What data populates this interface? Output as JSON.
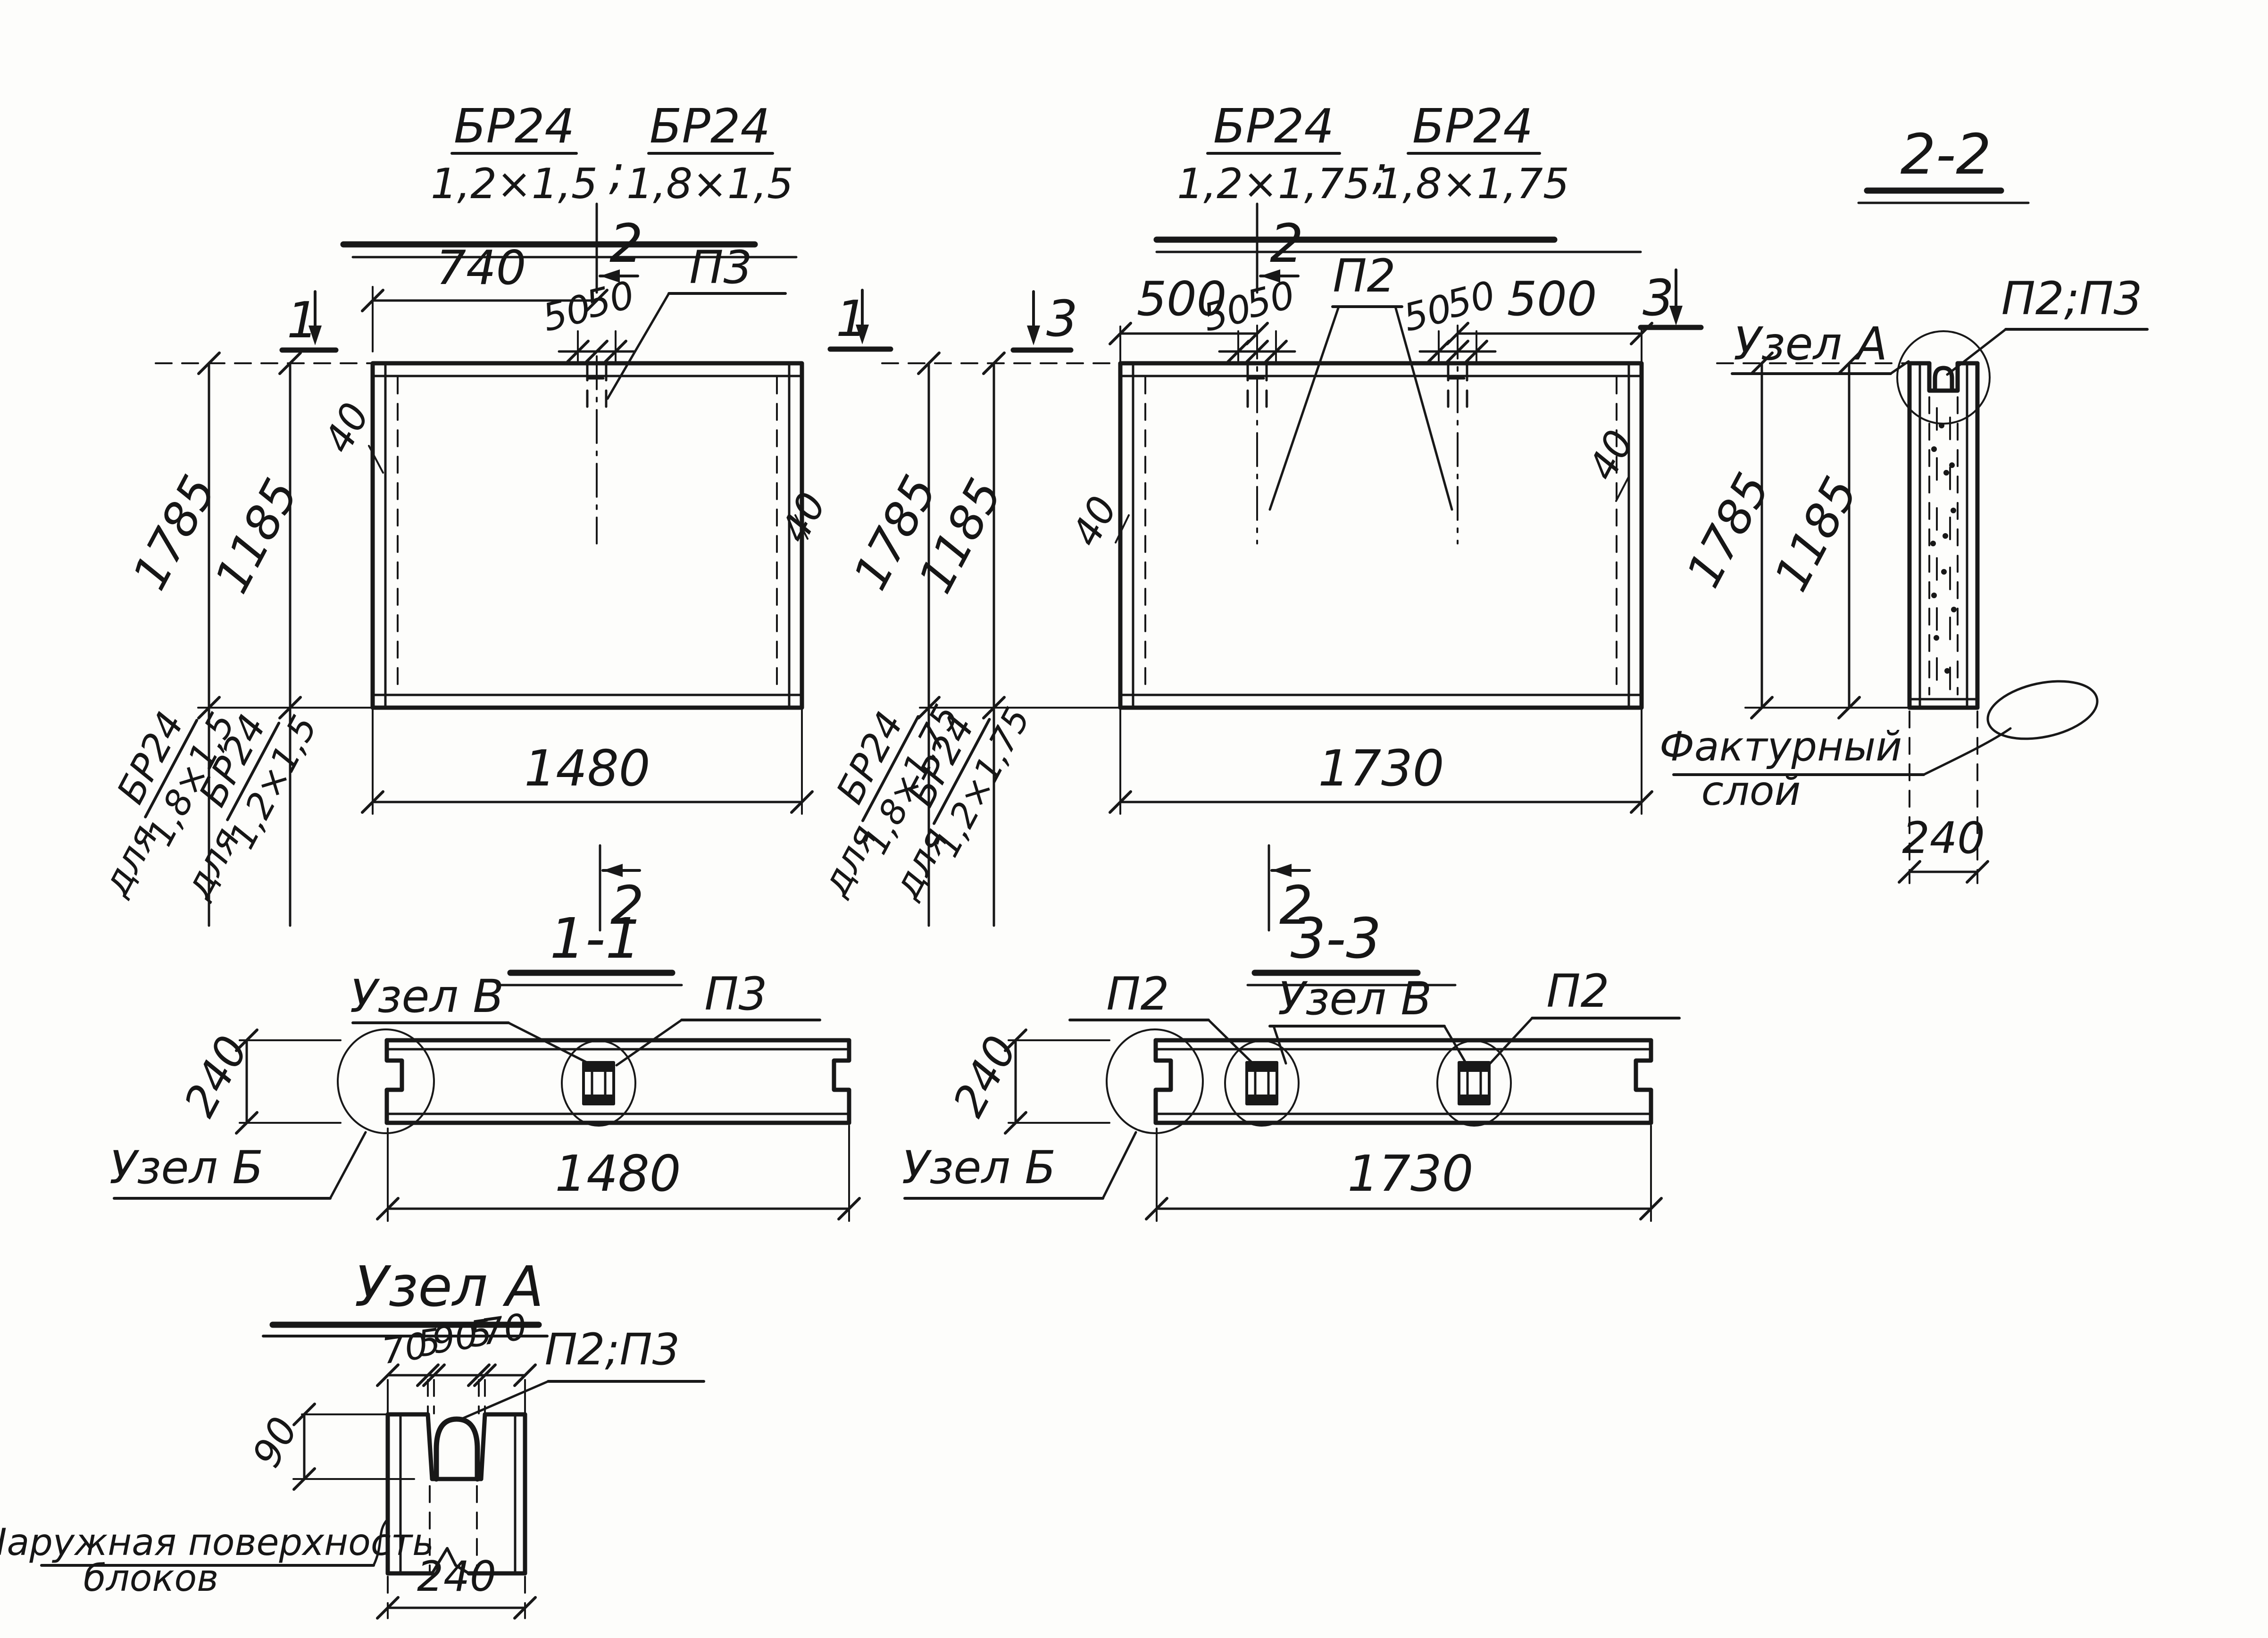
{
  "v1": {
    "t1n": "БР24",
    "t1d": "1,2×1,5",
    "sep": ";",
    "t2n": "БР24",
    "t2d": "1,8×1,5",
    "dim740": "740",
    "dim50a": "50",
    "dim50b": "50",
    "p3": "П3",
    "sec2top": "2",
    "sec2bot": "2",
    "sec1l": "1",
    "sec1r": "1",
    "dim1785": "1785",
    "dim1185": "1185",
    "dim1480": "1480",
    "dim40l": "40",
    "dim40r": "40",
    "fA_pre": "для",
    "fA_n": "БР24",
    "fA_d": "1,8×1,5",
    "fB_pre": "для",
    "fB_n": "БР24",
    "fB_d": "1,2×1,5"
  },
  "v2": {
    "t1n": "БР24",
    "t1d": "1,2×1,75",
    "sep": ";",
    "t2n": "БР24",
    "t2d": "1,8×1,75",
    "dim500l": "500",
    "dim500r": "500",
    "dim50a": "50",
    "dim50b": "50",
    "dim50c": "50",
    "dim50d": "50",
    "p2": "П2",
    "sec2top": "2",
    "sec2bot": "2",
    "sec3l": "3",
    "sec3r": "3",
    "dim1785": "1785",
    "dim1185": "1185",
    "dim1730": "1730",
    "dim40l": "40",
    "dim40r": "40",
    "fA_pre": "для",
    "fA_n": "БР24",
    "fA_d": "1,8×1,75",
    "fB_pre": "для",
    "fB_n": "БР24",
    "fB_d": "1,2×1,75"
  },
  "s11": {
    "title": "1-1",
    "uzelV": "Узел В",
    "p3": "П3",
    "uzelB": "Узел Б",
    "dim240": "240",
    "dim1480": "1480"
  },
  "s33": {
    "title": "3-3",
    "p2l": "П2",
    "uzelV": "Узел В",
    "p2r": "П2",
    "uzelB": "Узел Б",
    "dim240": "240",
    "dim1730": "1730"
  },
  "s22": {
    "title": "2-2",
    "uzelA": "Узел А",
    "p23": "П2;П3",
    "dim1785": "1785",
    "dim1185": "1185",
    "dim240": "240",
    "fact1": "Фактурный",
    "fact2": "слой"
  },
  "uA": {
    "title": "Узел А",
    "p23": "П2;П3",
    "d70a": "70",
    "d5a": "5",
    "d90": "90",
    "d5b": "5",
    "d70b": "70",
    "dim90": "90",
    "dim240": "240",
    "surf1": "Наружная поверхность",
    "surf2": "блоков"
  }
}
